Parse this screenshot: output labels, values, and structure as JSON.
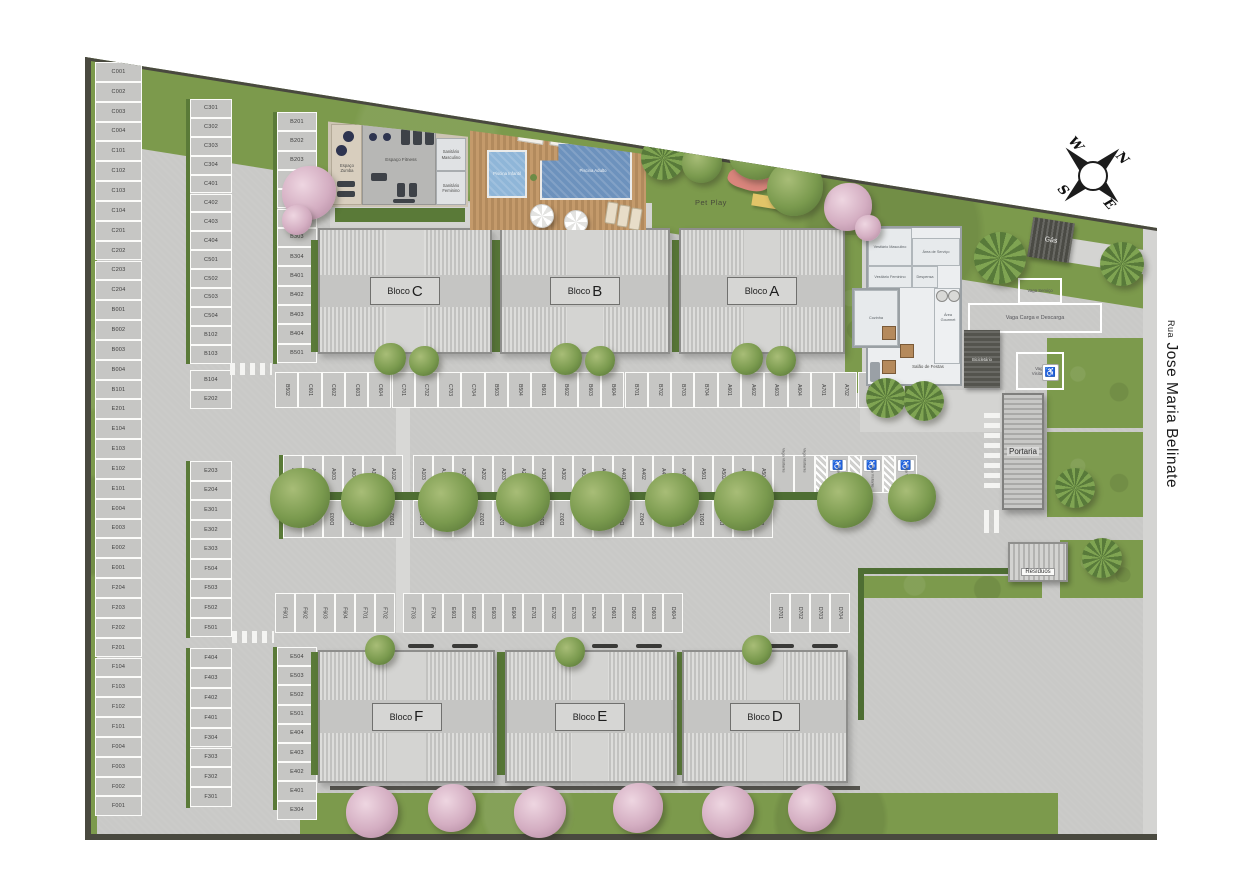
{
  "street": {
    "prefix": "Rua",
    "name": "Jose Maria Belinate"
  },
  "compass": {
    "north": "N",
    "east": "E",
    "south": "S",
    "west": "W"
  },
  "blocks": [
    {
      "id": "C",
      "prefix": "Bloco",
      "letter": "C"
    },
    {
      "id": "B",
      "prefix": "Bloco",
      "letter": "B"
    },
    {
      "id": "A",
      "prefix": "Bloco",
      "letter": "A"
    },
    {
      "id": "F",
      "prefix": "Bloco",
      "letter": "F"
    },
    {
      "id": "E",
      "prefix": "Bloco",
      "letter": "E"
    },
    {
      "id": "D",
      "prefix": "Bloco",
      "letter": "D"
    }
  ],
  "amenities": {
    "gym": {
      "zumba": "Espaço Zumba",
      "fitness": "Espaço Fitness",
      "sanitario_m": "Sanitário Masculino",
      "sanitario_f": "Sanitário Feminino"
    },
    "pool": {
      "infantil": "Piscina Infantil",
      "adulto": "Piscina Adulto"
    },
    "pet_play": "Pet Play"
  },
  "party_hall": {
    "vestiario_masculino": "Vestiário Masculino",
    "vestiario_feminino": "Vestiário Feminino",
    "area_servico": "Área de Serviço",
    "despensa": "Despensa",
    "cozinha": "Cozinha",
    "area_gourmet": "Área Gourmet",
    "salao": "Salão de Festas"
  },
  "facilities": {
    "gas": "Gás",
    "portaria": "Portaria",
    "residuos": "Resíduos",
    "bicicletario": "Bicicletário",
    "vaga_carga": "Vaga Carga e Descarga",
    "vaga_servico": "Vaga Serviço",
    "vaga_visitante": "Vaga Visitante"
  },
  "parking": {
    "stall_groups": [
      {
        "id": "col-left",
        "labels": [
          "C001",
          "C002",
          "C003",
          "C004",
          "C101",
          "C102",
          "C103",
          "C104",
          "C201",
          "C202",
          "C203",
          "C204",
          "B001",
          "B002",
          "B003",
          "B004",
          "B101",
          "E201",
          "E104",
          "E103",
          "E102",
          "E101",
          "E004",
          "E003",
          "E002",
          "E001",
          "F204",
          "F203",
          "F202",
          "F201",
          "F104",
          "F103",
          "F102",
          "F101",
          "F004",
          "F003",
          "F002",
          "F001"
        ]
      },
      {
        "id": "col-2a",
        "labels": [
          "C301",
          "C302",
          "C303",
          "C304",
          "C401",
          "C402",
          "C403",
          "C404",
          "C501",
          "C502",
          "C503",
          "C504",
          "B102",
          "B103"
        ]
      },
      {
        "id": "col-2b",
        "labels": [
          "B104",
          "E202"
        ]
      },
      {
        "id": "col-2c",
        "labels": [
          "E203",
          "E204",
          "E301",
          "E302",
          "E303",
          "F504",
          "F503",
          "F502",
          "F501"
        ]
      },
      {
        "id": "col-2d",
        "labels": [
          "F404",
          "F403",
          "F402",
          "F401",
          "F304",
          "F303",
          "F302",
          "F301"
        ]
      },
      {
        "id": "col-3a",
        "labels": [
          "B201",
          "B202",
          "B203",
          "B204",
          "B301",
          "B302",
          "B303",
          "B304",
          "B401",
          "B402",
          "B403",
          "B404",
          "B501"
        ]
      },
      {
        "id": "col-3b",
        "labels": [
          "E504",
          "E503",
          "E502",
          "E501",
          "E404",
          "E403",
          "E402",
          "E401",
          "E304"
        ]
      },
      {
        "id": "row-top",
        "labels": [
          "B502",
          "C601",
          "C602",
          "C603",
          "C604",
          "C701",
          "C702",
          "C703",
          "C704",
          "B503",
          "B504",
          "B601",
          "B602",
          "B603",
          "B604",
          "B701",
          "B702",
          "B703",
          "B704",
          "A601",
          "A602",
          "A603",
          "A604",
          "A701",
          "A702",
          "A703",
          "A704"
        ]
      },
      {
        "id": "row-mid-upper-a",
        "labels": [
          "A001",
          "A002",
          "A003",
          "A004",
          "A101",
          "A102"
        ]
      },
      {
        "id": "row-mid-upper-b",
        "labels": [
          "A103",
          "A104",
          "A201",
          "A202",
          "A203",
          "A204",
          "A301",
          "A302",
          "A303",
          "A304",
          "A401",
          "A402",
          "A403",
          "A404",
          "A501",
          "A502",
          "A503",
          "A504"
        ]
      },
      {
        "id": "row-mid-upper-special",
        "items": [
          {
            "kind": "label",
            "text": "Vaga Visitante"
          },
          {
            "kind": "label",
            "text": "Vaga Visitante"
          },
          {
            "kind": "hatch"
          },
          {
            "kind": "access",
            "text": "Vaga Visitante"
          },
          {
            "kind": "hatch"
          },
          {
            "kind": "access",
            "text": "Vaga Visitante"
          },
          {
            "kind": "hatch"
          },
          {
            "kind": "access",
            "text": "Vaga Visitante"
          }
        ]
      },
      {
        "id": "row-mid-lower-a",
        "labels": [
          "D001",
          "D002",
          "D003",
          "D004",
          "D101",
          "D102"
        ]
      },
      {
        "id": "row-mid-lower-b",
        "labels": [
          "D103",
          "D104",
          "D201",
          "D202",
          "D203",
          "D204",
          "D301",
          "D302",
          "D303",
          "D304",
          "D401",
          "D402",
          "D403",
          "D404",
          "D501",
          "D502",
          "D503",
          "D504"
        ]
      },
      {
        "id": "row-bottom-a",
        "labels": [
          "F601",
          "F602",
          "F603",
          "F604",
          "F701",
          "F702"
        ]
      },
      {
        "id": "row-bottom-b",
        "labels": [
          "F703",
          "F704",
          "E601",
          "E602",
          "E603",
          "E604",
          "E701",
          "E702",
          "E703",
          "E704",
          "D601",
          "D602",
          "D603",
          "D604"
        ]
      },
      {
        "id": "row-bottom-c",
        "labels": [
          "D701",
          "D702",
          "D703",
          "D704"
        ]
      }
    ]
  },
  "colors": {
    "grass": "#7c9a4c",
    "concrete": "#c9c9c7",
    "pool_adult": "#6d92bd",
    "pool_kids": "#8fb6d8",
    "deck_wood": "#b98f62",
    "wall": "#49493f"
  }
}
